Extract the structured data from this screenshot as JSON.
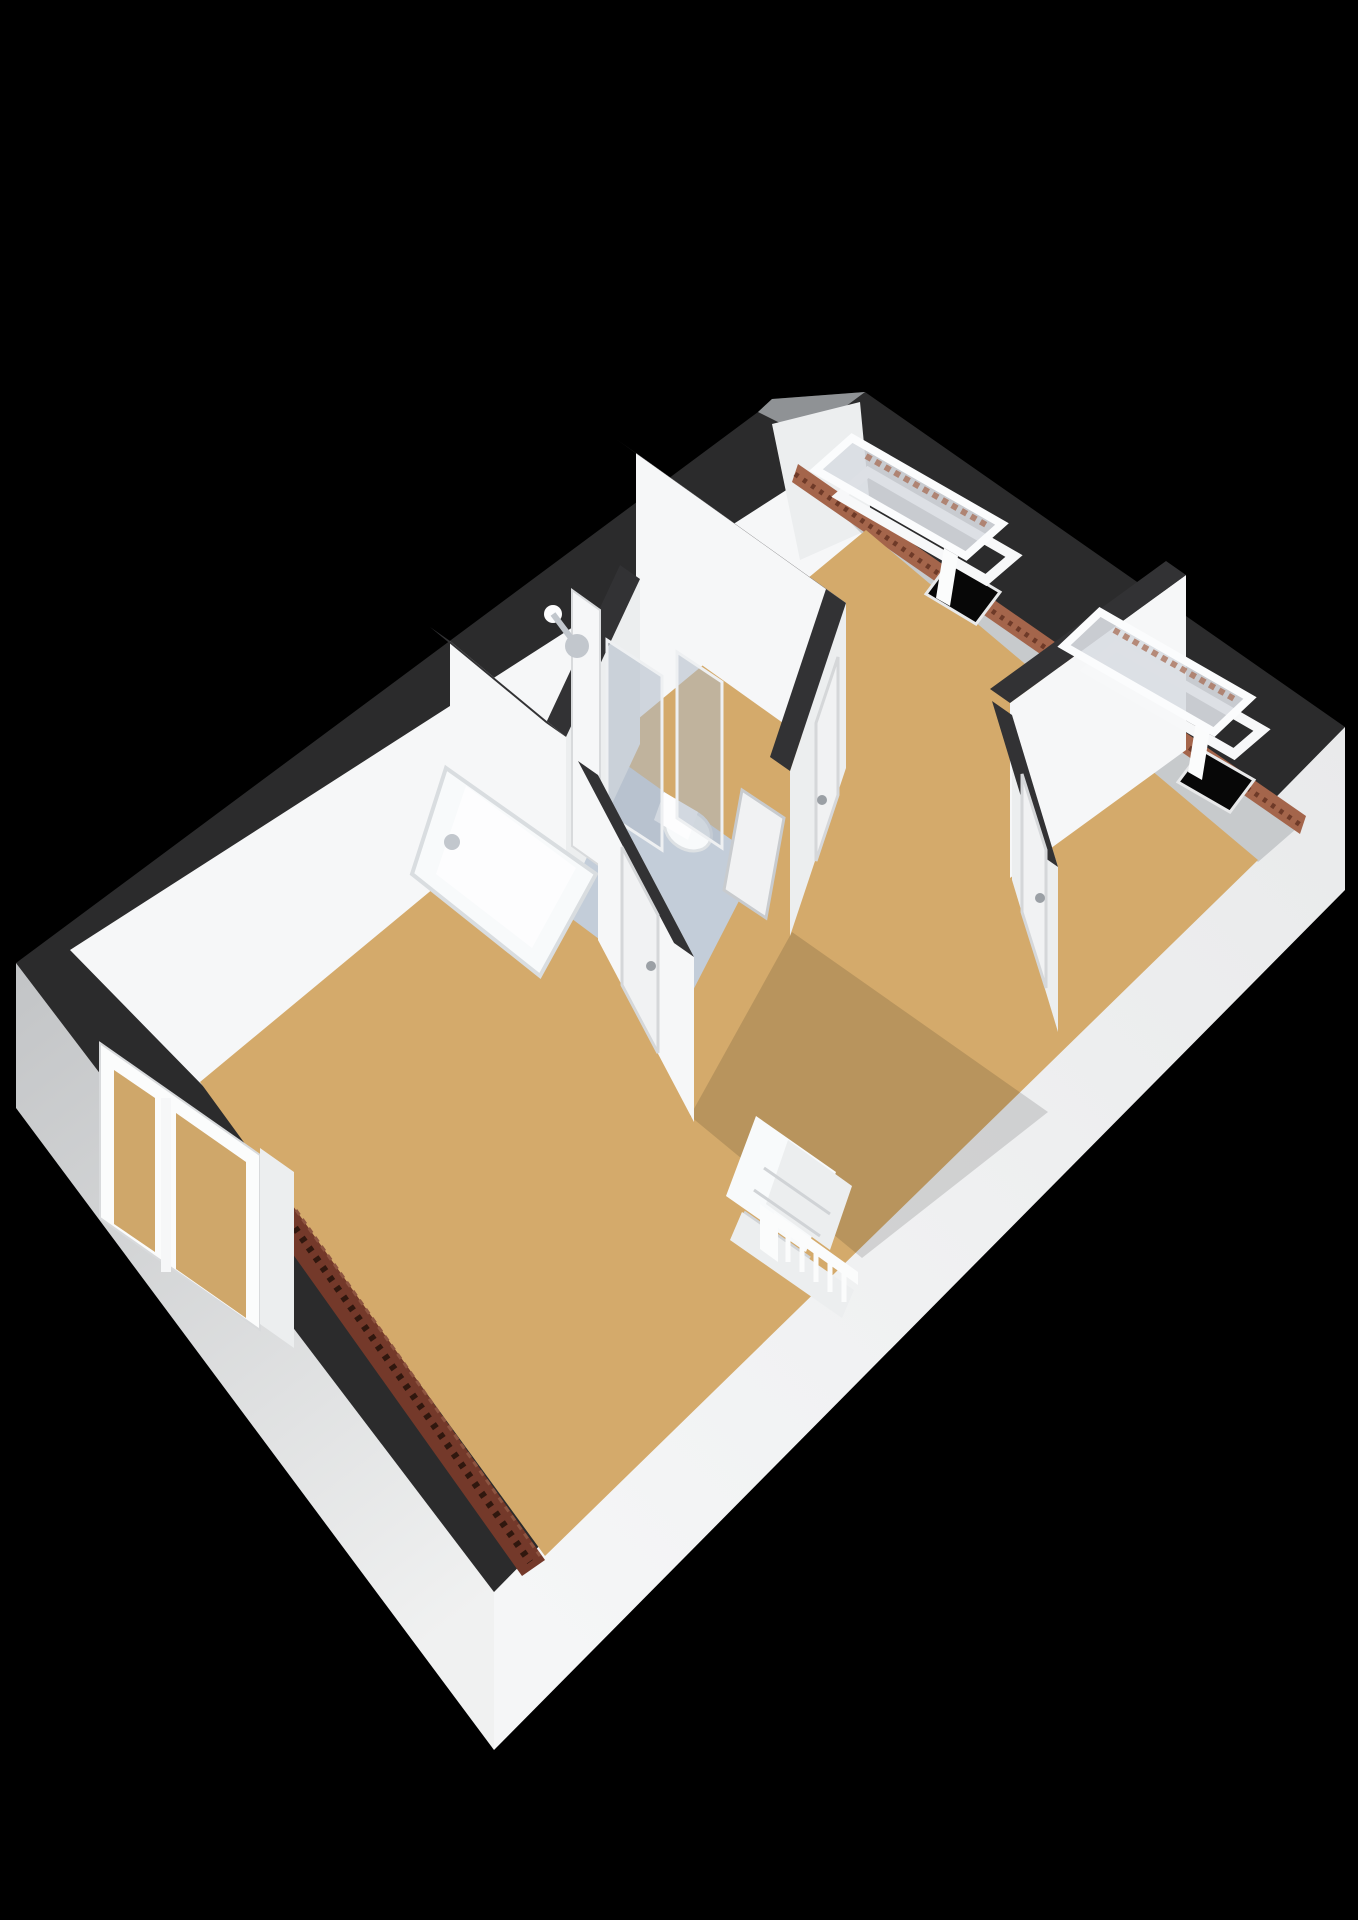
{
  "canvas": {
    "width": 1358,
    "height": 1920,
    "view": "3d-floorplan-isometric-render",
    "storey": "attic-floor"
  },
  "colors": {
    "background": "#000000",
    "band": "#2b2b2c",
    "band_top": "#323234",
    "gable_roof": "#8f9295",
    "ext_wall_from": "#c2c4c6",
    "ext_wall_to": "#f0f1f1",
    "ext_se_from": "#e9eaeb",
    "ext_se_to": "#f5f6f7",
    "int_white": "#f6f7f8",
    "int_white2": "#eceeef",
    "int_gray": "#c7cacc",
    "floor_wood": "#d4aa6b",
    "floor_wood_glass": "#cfa76a",
    "floor_bath": "#c3cdd9",
    "brick_ne": "#a4654b",
    "brick_ne_groove": "#6e3a28",
    "brick_sw": "#74392a",
    "brick_sw_groove": "#30170e",
    "brick_sw_light": "#8d5440",
    "fixture_white": "#f8fafb",
    "fixture_white2": "#fdfdfe",
    "glass": "#aeb9c6",
    "sash_glass": "#d9dde2",
    "frame_white": "#fbfcfc",
    "door": "#f1f2f3",
    "handle": "#9ba0a5",
    "metal": "#c2c7cd",
    "opening": "#070707"
  },
  "scene": {
    "rooms": [
      {
        "name": "bedroom-north",
        "floor_material": "wood"
      },
      {
        "name": "bedroom-east",
        "floor_material": "wood"
      },
      {
        "name": "bathroom",
        "floor_material": "light-blue-vinyl"
      },
      {
        "name": "landing-hall",
        "floor_material": "wood"
      },
      {
        "name": "bedroom-southwest",
        "floor_material": "wood"
      },
      {
        "name": "closet",
        "floor_material": "hidden"
      }
    ],
    "fixtures": [
      "bathtub",
      "bath-faucet",
      "shower-head",
      "glass-shower-screen",
      "toilet",
      "staircase",
      "stair-railing"
    ],
    "windows": [
      {
        "type": "roof-window",
        "state": "open",
        "location": "north-east-roof-near-gable"
      },
      {
        "type": "roof-window",
        "state": "open",
        "location": "north-east-roof-east"
      },
      {
        "type": "double-casement-window",
        "state": "closed",
        "location": "south-west-wall"
      }
    ],
    "doors": [
      {
        "location": "hall-to-southwest-bedroom",
        "state": "closed"
      },
      {
        "location": "hall-to-east-bedroom",
        "state": "closed"
      },
      {
        "location": "hall-to-bathroom-wall",
        "state": "closed"
      },
      {
        "location": "bathroom",
        "state": "open"
      }
    ],
    "roof_details": [
      "tiled-edge-north-east",
      "tiled-edge-south-tip",
      "gable-north"
    ]
  }
}
